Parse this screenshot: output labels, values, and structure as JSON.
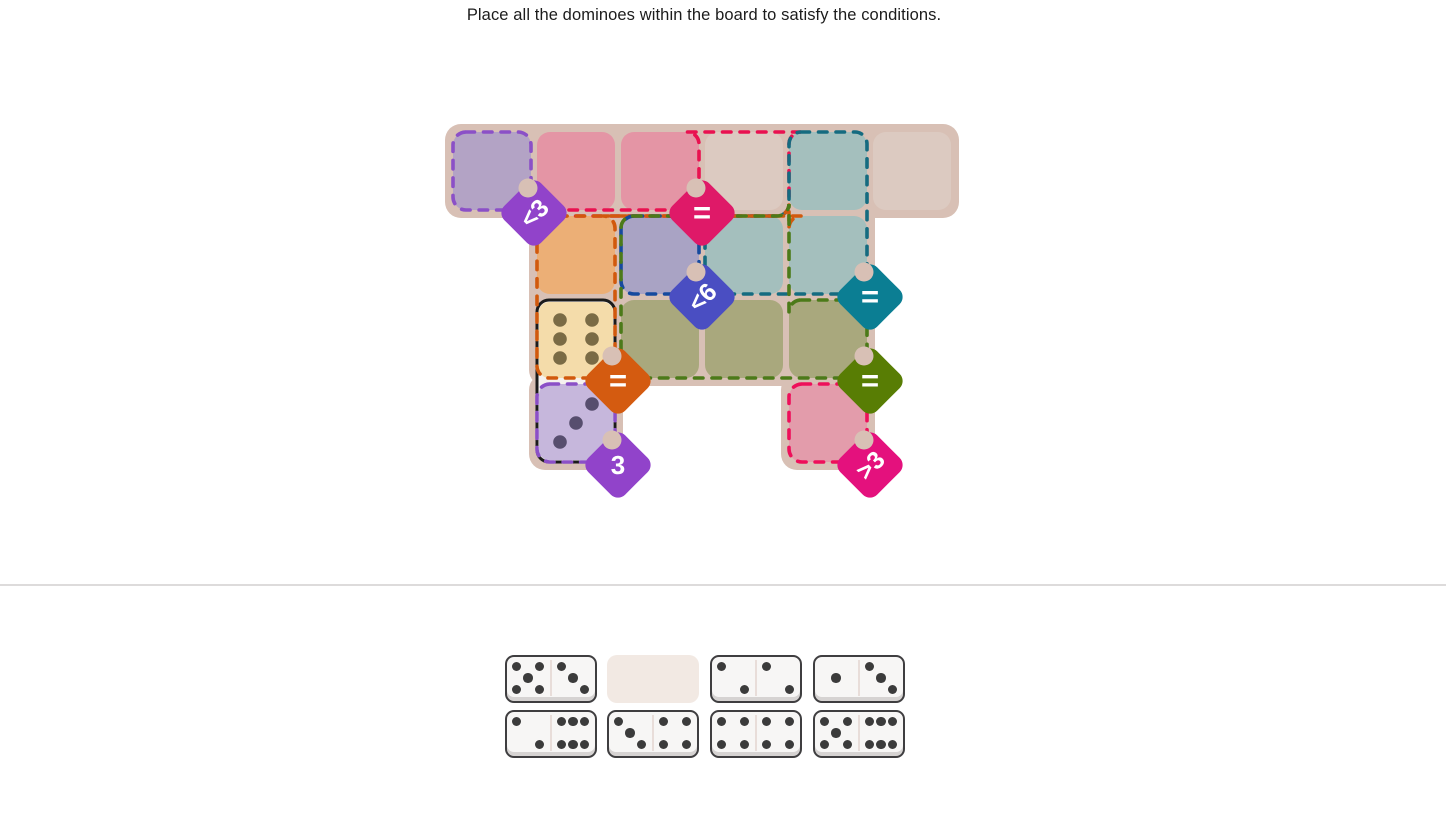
{
  "title": "Place all the dominoes within the board to satisfy the conditions.",
  "board": {
    "colors": {
      "bg": "#d8c0b5",
      "plain_cell": "#dccac1",
      "domino_body": "#f5f2ef"
    },
    "grid": {
      "origin_x": 453,
      "origin_y": 132,
      "cell": 78,
      "pitch": 84
    },
    "plain_cells": [
      {
        "row": 1,
        "col": 4
      },
      {
        "row": 1,
        "col": 6
      }
    ],
    "regions": [
      {
        "id": "purple-top",
        "condition": "<3",
        "rotated": true,
        "fill": "#b3a3c5",
        "stroke": "#8b50c7",
        "badge_fill": "#9143ca",
        "cells": [
          {
            "row": 1,
            "col": 1
          }
        ]
      },
      {
        "id": "red-top",
        "condition": "=",
        "rotated": false,
        "fill": "#e495a5",
        "stroke": "#e91150",
        "badge_fill": "#df1968",
        "cells": [
          {
            "row": 1,
            "col": 2
          },
          {
            "row": 1,
            "col": 3
          }
        ]
      },
      {
        "id": "teal",
        "condition": "=",
        "rotated": false,
        "fill": "#a4bfbd",
        "stroke": "#156b80",
        "badge_fill": "#0b7e93",
        "cells": [
          {
            "row": 1,
            "col": 5
          },
          {
            "row": 2,
            "col": 4
          },
          {
            "row": 2,
            "col": 5
          }
        ]
      },
      {
        "id": "orange",
        "condition": "=",
        "rotated": false,
        "fill": "#ecaf76",
        "stroke": "#d1590d",
        "badge_fill": "#d45b10",
        "cells": [
          {
            "row": 2,
            "col": 2
          },
          {
            "row": 3,
            "col": 2
          }
        ]
      },
      {
        "id": "indigo",
        "condition": "<6",
        "rotated": true,
        "fill": "#a9a3c4",
        "stroke": "#164a9e",
        "badge_fill": "#4a4ec2",
        "cells": [
          {
            "row": 2,
            "col": 3
          }
        ]
      },
      {
        "id": "green",
        "condition": "=",
        "rotated": false,
        "fill": "#a9a87d",
        "stroke": "#4c7a19",
        "badge_fill": "#587d04",
        "cells": [
          {
            "row": 3,
            "col": 3
          },
          {
            "row": 3,
            "col": 4
          },
          {
            "row": 3,
            "col": 5
          }
        ]
      },
      {
        "id": "purple-bottom",
        "condition": "3",
        "rotated": false,
        "fill": "#c4b5da",
        "stroke": "#8b50c7",
        "badge_fill": "#9143ca",
        "cells": [
          {
            "row": 4,
            "col": 2
          }
        ]
      },
      {
        "id": "red-bottom",
        "condition": ">3",
        "rotated": true,
        "fill": "#e39cab",
        "stroke": "#ee0f5a",
        "badge_fill": "#e4117d",
        "cells": [
          {
            "row": 4,
            "col": 5
          }
        ]
      }
    ],
    "placed_domino": {
      "col": 2,
      "top_row": 3,
      "orientation": "vertical",
      "outline_color": "#1b1b1b",
      "halves": [
        {
          "pips": 6,
          "fill": "#f4dcaa",
          "pip_color": "#7a6b45",
          "mirror": false
        },
        {
          "pips": 3,
          "fill": "#c6b7dc",
          "pip_color": "#574e6e",
          "mirror": true
        }
      ]
    }
  },
  "tray": {
    "xs": [
      505,
      607,
      710,
      813
    ],
    "ys": [
      655,
      710
    ],
    "slots": [
      {
        "type": "domino",
        "pips": [
          5,
          3
        ]
      },
      {
        "type": "empty"
      },
      {
        "type": "domino",
        "pips": [
          2,
          2
        ]
      },
      {
        "type": "domino",
        "pips": [
          1,
          3
        ]
      },
      {
        "type": "domino",
        "pips": [
          2,
          6
        ]
      },
      {
        "type": "domino",
        "pips": [
          3,
          4
        ]
      },
      {
        "type": "domino",
        "pips": [
          4,
          4
        ]
      },
      {
        "type": "domino",
        "pips": [
          5,
          6
        ]
      }
    ],
    "colors": {
      "empty_slot": "#f2e9e3",
      "domino_fill": "#f7f6f5",
      "domino_border": "#3f3e40",
      "pip": "#3b3b3b"
    }
  }
}
